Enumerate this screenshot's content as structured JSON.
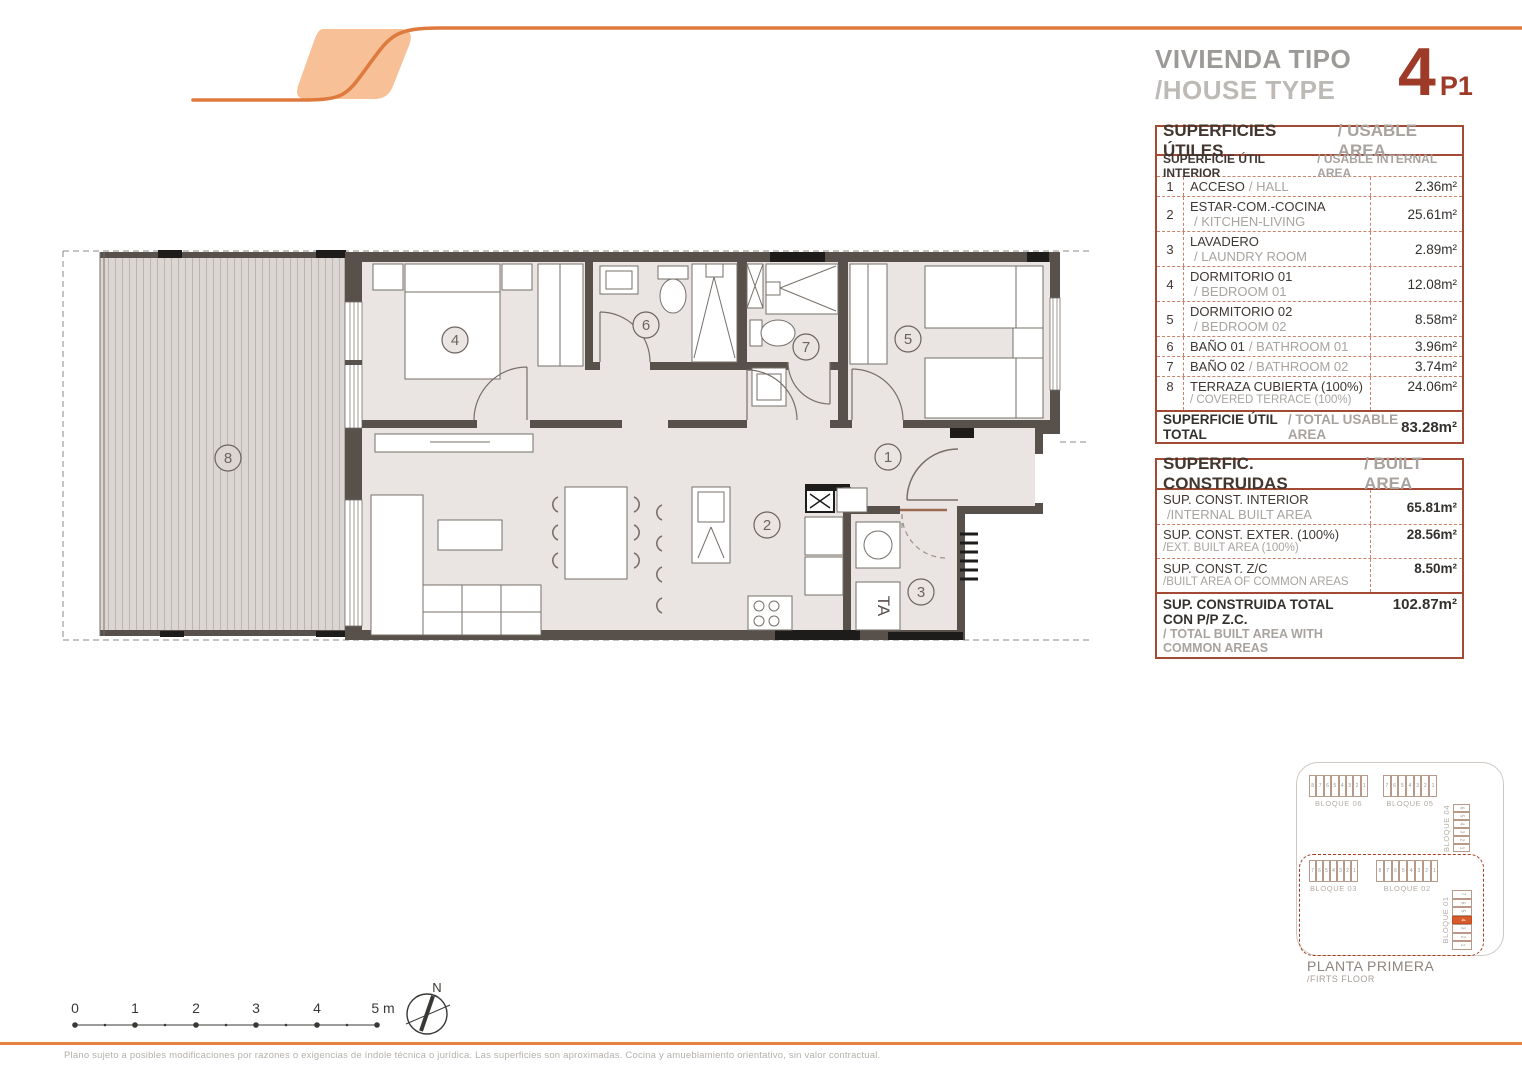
{
  "header": {
    "title_es": "VIVIENDA TIPO",
    "title_en": "/HOUSE TYPE",
    "type_number": "4",
    "floor_code": "P1"
  },
  "usable": {
    "title_es": "SUPERFICIES ÚTILES",
    "title_en": "/ USABLE AREA",
    "subtitle_es": "SUPERFICIE ÚTIL INTERIOR",
    "subtitle_en": "/ USABLE INTERNAL AREA",
    "rows": [
      {
        "num": "1",
        "es": "ACCESO",
        "en": "/ HALL",
        "value": "2.36m²"
      },
      {
        "num": "2",
        "es": "ESTAR-COM.-COCINA",
        "en": "/ KITCHEN-LIVING",
        "value": "25.61m²"
      },
      {
        "num": "3",
        "es": "LAVADERO",
        "en": "/ LAUNDRY ROOM",
        "value": "2.89m²"
      },
      {
        "num": "4",
        "es": "DORMITORIO 01",
        "en": "/ BEDROOM 01",
        "value": "12.08m²"
      },
      {
        "num": "5",
        "es": "DORMITORIO 02",
        "en": "/ BEDROOM 02",
        "value": "8.58m²"
      },
      {
        "num": "6",
        "es": "BAÑO 01",
        "en": "/ BATHROOM 01",
        "value": "3.96m²"
      },
      {
        "num": "7",
        "es": "BAÑO 02",
        "en": "/ BATHROOM 02",
        "value": "3.74m²"
      },
      {
        "num": "8",
        "es": "TERRAZA CUBIERTA (100%)",
        "en": "/ COVERED TERRACE (100%)",
        "value": "24.06m²"
      }
    ],
    "total_es": "SUPERFICIE ÚTIL TOTAL",
    "total_en": "/ TOTAL USABLE AREA",
    "total_value": "83.28m²"
  },
  "built": {
    "title_es": "SUPERFIC. CONSTRUIDAS",
    "title_en": "/ BUILT AREA",
    "rows": [
      {
        "es": "SUP. CONST. INTERIOR",
        "en": "/INTERNAL BUILT AREA",
        "value": "65.81m²"
      },
      {
        "es": "SUP. CONST. EXTER. (100%)",
        "en": "/EXT. BUILT AREA (100%)",
        "value": "28.56m²"
      },
      {
        "es": "SUP. CONST. Z/C",
        "en": "/BUILT AREA OF COMMON AREAS",
        "value": "8.50m²"
      }
    ],
    "total_es": "SUP. CONSTRUIDA TOTAL CON P/P Z.C.",
    "total_en": "/ TOTAL BUILT AREA WITH COMMON AREAS",
    "total_value": "102.87m²"
  },
  "plan": {
    "rooms": [
      {
        "num": "1"
      },
      {
        "num": "2"
      },
      {
        "num": "3"
      },
      {
        "num": "4"
      },
      {
        "num": "5"
      },
      {
        "num": "6"
      },
      {
        "num": "7"
      },
      {
        "num": "8"
      }
    ],
    "washer_label": "TA"
  },
  "siteplan": {
    "blocks": [
      {
        "name": "BLOQUE 06",
        "units": [
          "8",
          "7",
          "6",
          "5",
          "4",
          "3",
          "2",
          "1"
        ]
      },
      {
        "name": "BLOQUE 05",
        "units": [
          "7",
          "6",
          "5",
          "4",
          "3",
          "2",
          "1"
        ]
      },
      {
        "name": "BLOQUE 04",
        "units": [
          "6",
          "5",
          "4",
          "3",
          "2",
          "1"
        ],
        "vertical": true
      },
      {
        "name": "BLOQUE 03",
        "units": [
          "7",
          "6",
          "5",
          "4",
          "3",
          "2",
          "1"
        ]
      },
      {
        "name": "BLOQUE 02",
        "units": [
          "8",
          "7",
          "6",
          "5",
          "4",
          "3",
          "2",
          "1"
        ]
      },
      {
        "name": "BLOQUE 01",
        "units": [
          "7",
          "6",
          "5",
          "4",
          "3",
          "2",
          "1"
        ],
        "vertical": true,
        "highlight": "4"
      }
    ],
    "caption_es": "PLANTA PRIMERA",
    "caption_en": "/FIRTS FLOOR"
  },
  "scalebar": {
    "ticks": [
      "0",
      "1",
      "2",
      "3",
      "4",
      "5 m"
    ]
  },
  "compass": {
    "label": "N"
  },
  "footer": {
    "disclaimer": "Plano sujeto a posibles modificaciones por razones o exigencias de índole técnica o jurídica. Las superficies son aproximadas. Cocina y amueblamiento orientativo, sin valor contractual."
  },
  "colors": {
    "accent": "#E8813F",
    "accent_fill": "#F7C096",
    "type_red": "#9E3A28",
    "table_border": "#A34A35",
    "wall": "#57504B",
    "floor": "#EAE5E2",
    "terrace": "#DBD6D2",
    "highlight": "#D95B2B"
  }
}
